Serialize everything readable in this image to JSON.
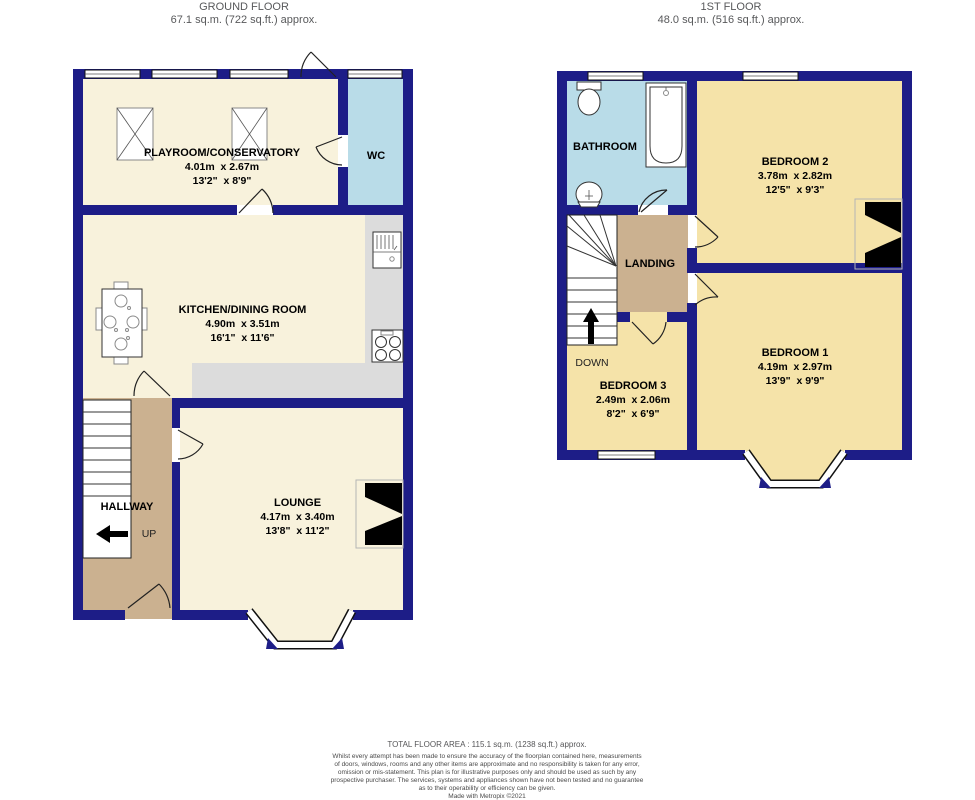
{
  "ground_floor": {
    "title": "GROUND FLOOR",
    "subtitle": "67.1 sq.m. (722 sq.ft.) approx.",
    "rooms": {
      "playroom": {
        "name": "PLAYROOM/CONSERVATORY",
        "metric": "4.01m  x 2.67m",
        "imperial": "13'2\"  x 8'9\""
      },
      "wc": {
        "name": "WC"
      },
      "kitchen": {
        "name": "KITCHEN/DINING ROOM",
        "metric": "4.90m  x 3.51m",
        "imperial": "16'1\"  x 11'6\""
      },
      "hallway": {
        "name": "HALLWAY",
        "direction": "UP"
      },
      "lounge": {
        "name": "LOUNGE",
        "metric": "4.17m  x 3.40m",
        "imperial": "13'8\"  x 11'2\""
      }
    }
  },
  "first_floor": {
    "title": "1ST FLOOR",
    "subtitle": "48.0 sq.m. (516 sq.ft.) approx.",
    "rooms": {
      "bathroom": {
        "name": "BATHROOM"
      },
      "bedroom2": {
        "name": "BEDROOM 2",
        "metric": "3.78m  x 2.82m",
        "imperial": "12'5\"  x 9'3\""
      },
      "landing": {
        "name": "LANDING",
        "direction": "DOWN"
      },
      "bedroom3": {
        "name": "BEDROOM 3",
        "metric": "2.49m  x 2.06m",
        "imperial": "8'2\"  x 6'9\""
      },
      "bedroom1": {
        "name": "BEDROOM 1",
        "metric": "4.19m  x 2.97m",
        "imperial": "13'9\"  x 9'9\""
      }
    }
  },
  "footer": {
    "total": "TOTAL FLOOR AREA : 115.1 sq.m. (1238 sq.ft.) approx.",
    "lines": [
      "Whilst every attempt has been made to ensure the accuracy of the floorplan contained here, measurements",
      "of doors, windows, rooms and any other items are approximate and no responsibility is taken for any error,",
      "omission or mis-statement. This plan is for illustrative purposes only and should be used as such by any",
      "prospective purchaser. The services, systems and appliances shown have not been tested and no guarantee",
      "as to their operability or efficiency can be given."
    ],
    "credit": "Made with Metropix ©2021"
  },
  "colors": {
    "wall": "#1d1d87",
    "ground_floor_room": "#f8f2dc",
    "first_floor_room": "#f5e3a9",
    "wet_room": "#b9dce8",
    "hall_landing": "#cbb190",
    "kitchen_counter": "#dcdcdc",
    "chimney": "#000000",
    "title_text": "#58595b",
    "label_text": "#000000",
    "footer_text": "#4a4a4a"
  }
}
